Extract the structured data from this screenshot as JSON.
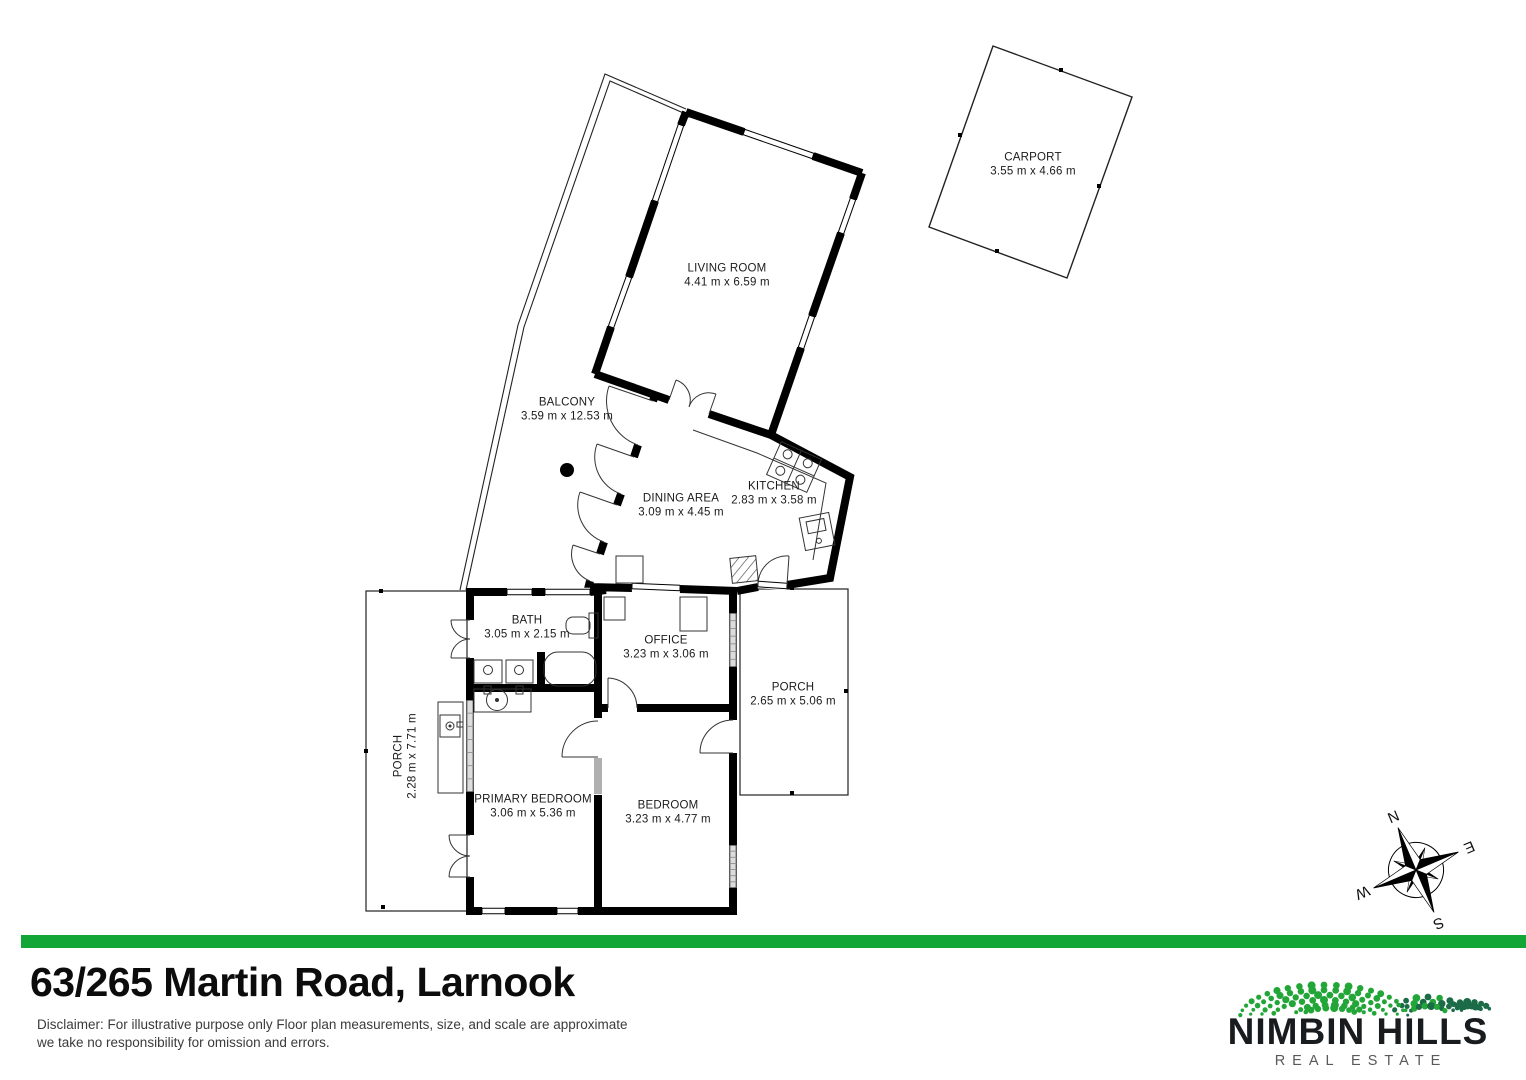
{
  "page": {
    "background": "#ffffff"
  },
  "floorplan": {
    "rooms": [
      {
        "name": "CARPORT",
        "dims": "3.55 m x 4.66 m"
      },
      {
        "name": "LIVING ROOM",
        "dims": "4.41 m x 6.59 m"
      },
      {
        "name": "BALCONY",
        "dims": "3.59 m x 12.53 m"
      },
      {
        "name": "DINING AREA",
        "dims": "3.09 m x 4.45 m"
      },
      {
        "name": "KITCHEN",
        "dims": "2.83 m x 3.58 m"
      },
      {
        "name": "BATH",
        "dims": "3.05 m x 2.15 m"
      },
      {
        "name": "OFFICE",
        "dims": "3.23 m x 3.06 m"
      },
      {
        "name": "PORCH",
        "dims": "2.65 m x 5.06 m"
      },
      {
        "name": "PORCH",
        "dims": "2.28 m x 7.71 m"
      },
      {
        "name": "PRIMARY BEDROOM",
        "dims": "3.06 m x 5.36 m"
      },
      {
        "name": "BEDROOM",
        "dims": "3.23 m x 4.77 m"
      }
    ],
    "compass": {
      "north": "N",
      "east": "E",
      "south": "S",
      "west": "W"
    }
  },
  "footer": {
    "address": "63/265 Martin Road, Larnook",
    "disclaimer_line1": "Disclaimer: For illustrative purpose only Floor plan measurements, size, and scale are approximate",
    "disclaimer_line2": "we take no responsibility for omission and errors.",
    "divider_color": "#12a636"
  },
  "brand": {
    "name": "NIMBIN HILLS",
    "tagline": "REAL ESTATE",
    "dot_green": "#23a638",
    "dot_dark_green": "#1c6b47"
  }
}
